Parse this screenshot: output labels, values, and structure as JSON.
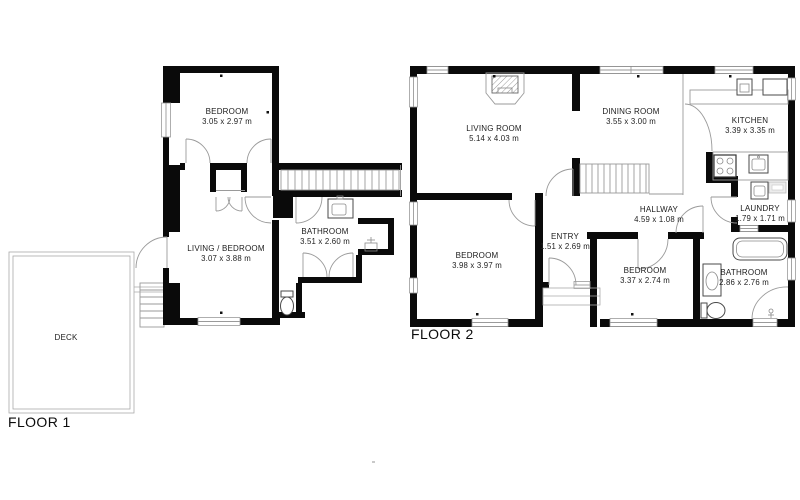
{
  "floors": {
    "floor1": {
      "label": "FLOOR 1",
      "rooms": {
        "bedroom": {
          "name": "BEDROOM",
          "dims": "3.05 x 2.97 m"
        },
        "living_bedroom": {
          "name": "LIVING / BEDROOM",
          "dims": "3.07 x 3.88 m"
        },
        "bathroom": {
          "name": "BATHROOM",
          "dims": "3.51 x 2.60 m"
        },
        "deck": {
          "name": "DECK"
        }
      }
    },
    "floor2": {
      "label": "FLOOR 2",
      "rooms": {
        "living_room": {
          "name": "LIVING ROOM",
          "dims": "5.14 x 4.03 m"
        },
        "dining_room": {
          "name": "DINING ROOM",
          "dims": "3.55 x 3.00 m"
        },
        "kitchen": {
          "name": "KITCHEN",
          "dims": "3.39 x 3.35 m"
        },
        "hallway": {
          "name": "HALLWAY",
          "dims": "4.59 x 1.08 m"
        },
        "entry": {
          "name": "ENTRY",
          "dims": "1.51 x 2.69 m"
        },
        "laundry": {
          "name": "LAUNDRY",
          "dims": "1.79 x 1.71 m"
        },
        "bedroom_1": {
          "name": "BEDROOM",
          "dims": "3.98 x 3.97 m"
        },
        "bedroom_2": {
          "name": "BEDROOM",
          "dims": "3.37 x 2.74 m"
        },
        "bathroom": {
          "name": "BATHROOM",
          "dims": "2.86 x 2.76 m"
        }
      }
    }
  },
  "colors": {
    "wall": "#0a0a0a",
    "thin_line": "#9a9a9a",
    "text": "#1c1c1c"
  }
}
